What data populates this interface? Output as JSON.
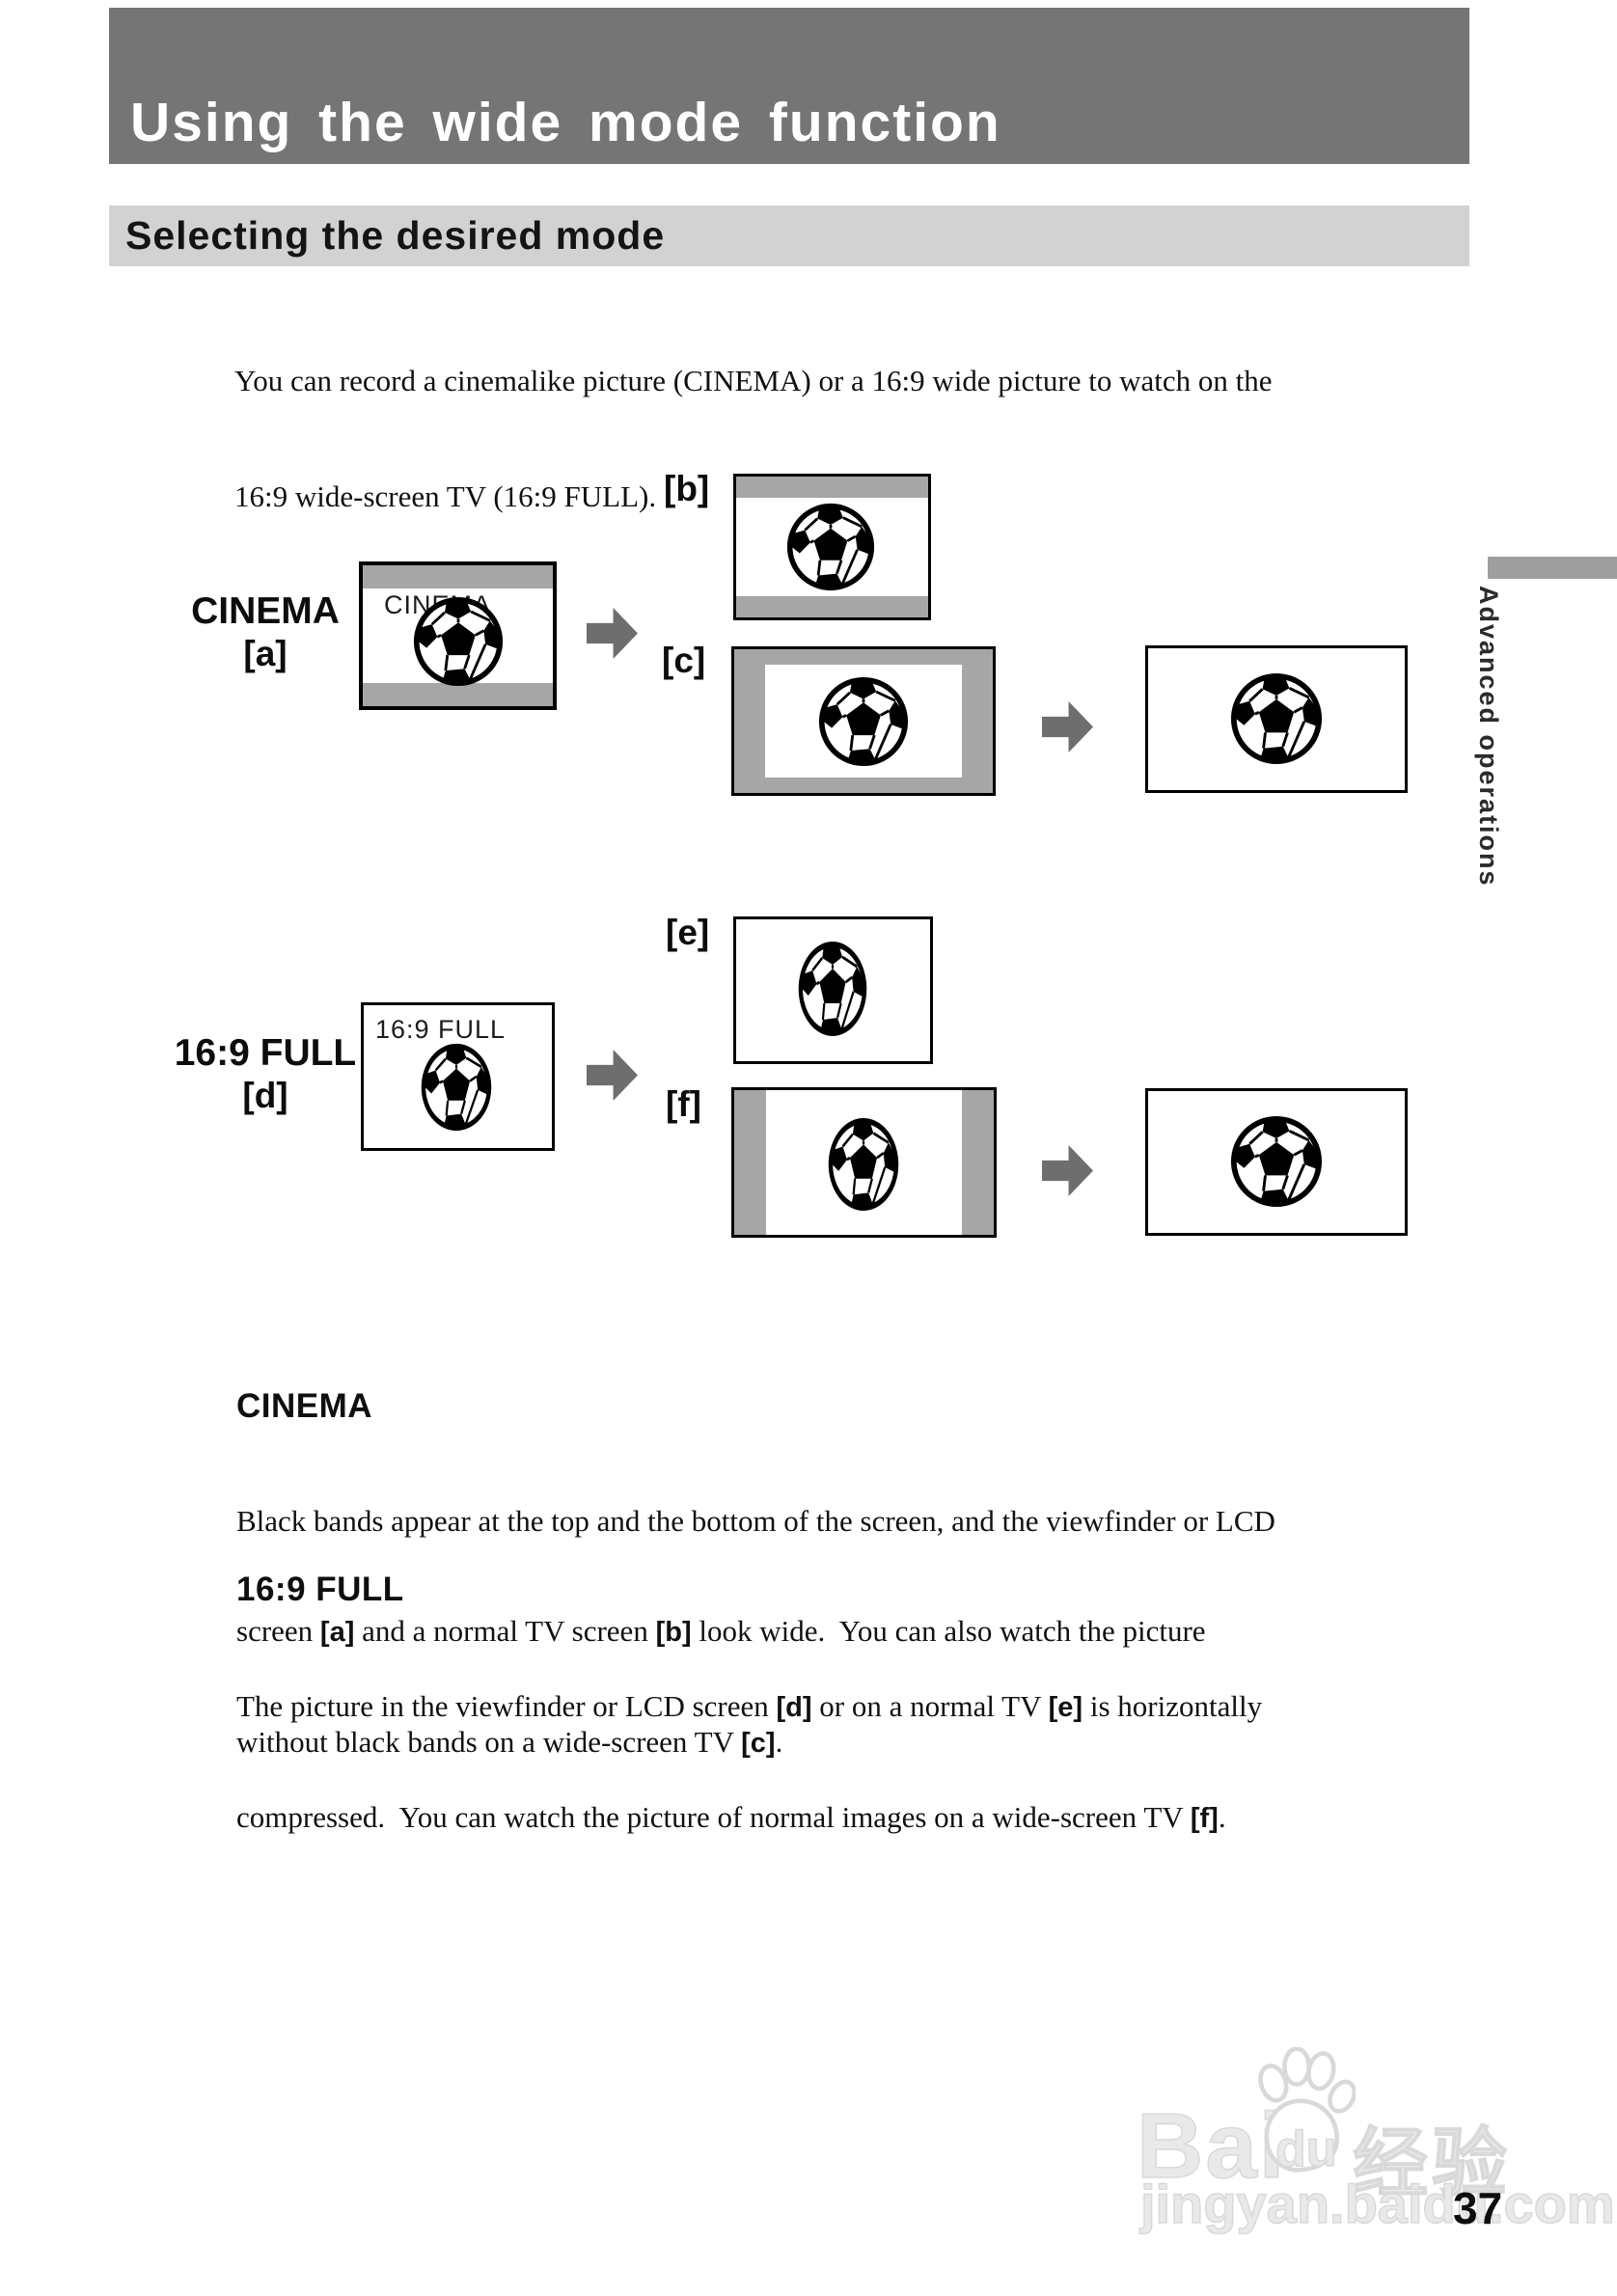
{
  "page": {
    "title": "Using the wide mode function",
    "section_heading": "Selecting the desired mode",
    "intro_lines": [
      "You can record a cinemalike picture (CINEMA) or a 16:9 wide picture to watch on the",
      "16:9 wide-screen TV (16:9 FULL)."
    ],
    "side_tab_label": "Advanced operations",
    "page_number": "37"
  },
  "diagram": {
    "cinema_label": "CINEMA",
    "cinema_ref": "[a]",
    "cinema_screen_text": "CINEMA",
    "ref_b": "[b]",
    "ref_c": "[c]",
    "full_label": "16:9 FULL",
    "full_ref": "[d]",
    "full_screen_text": "16:9 FULL",
    "ref_e": "[e]",
    "ref_f": "[f]"
  },
  "sections": {
    "cinema": {
      "heading": "CINEMA",
      "lines": [
        [
          {
            "t": "Black bands appear at the top and the bottom of the screen, and the viewfinder or LCD"
          }
        ],
        [
          {
            "t": "screen "
          },
          {
            "t": "[a]",
            "b": true
          },
          {
            "t": " and a normal TV screen "
          },
          {
            "t": "[b]",
            "b": true
          },
          {
            "t": " look wide.  You can also watch the picture"
          }
        ],
        [
          {
            "t": "without black bands on a wide-screen TV "
          },
          {
            "t": "[c]",
            "b": true
          },
          {
            "t": "."
          }
        ]
      ]
    },
    "full": {
      "heading": "16:9 FULL",
      "lines": [
        [
          {
            "t": "The picture in the viewfinder or LCD screen "
          },
          {
            "t": "[d]",
            "b": true
          },
          {
            "t": " or on a normal TV "
          },
          {
            "t": "[e]",
            "b": true
          },
          {
            "t": " is horizontally"
          }
        ],
        [
          {
            "t": "compressed.  You can watch the picture of normal images on a wide-screen TV "
          },
          {
            "t": "[f]",
            "b": true
          },
          {
            "t": "."
          }
        ]
      ]
    }
  },
  "watermark": {
    "brand": "Bai",
    "brand_du": "du",
    "brand_cn": "经验",
    "url": "jingyan.baidu.com"
  },
  "colors": {
    "title_bar": "#757575",
    "section_bar": "#d2d2d2",
    "band_gray": "#a6a6a6",
    "arrow_gray": "#6e6e6e",
    "tab_gray": "#9e9e9e"
  }
}
